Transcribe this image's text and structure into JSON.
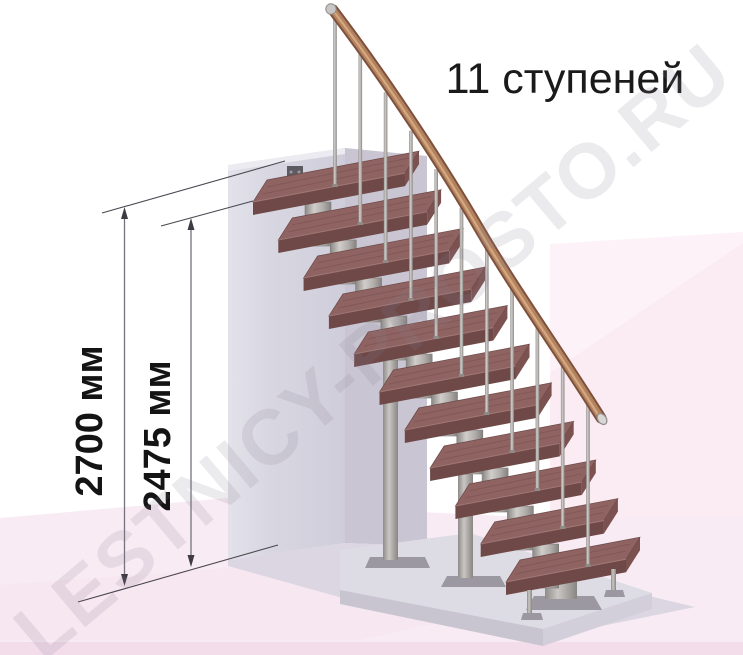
{
  "title": "11 ступеней",
  "watermark": "LESTNICY-PROSTO.RU",
  "staircase": {
    "step_count": 11,
    "description_label": "11 ступеней"
  },
  "dimensions": {
    "total_height": {
      "label": "2700 мм",
      "value": 2700,
      "unit": "мм"
    },
    "to_top_step": {
      "label": "2475 мм",
      "value": 2475,
      "unit": "мм"
    }
  },
  "colors": {
    "tread_top": "#8f6361",
    "tread_front": "#6e4948",
    "tread_end": "#7c5251",
    "tread_edge": "#6d4a49",
    "tread_streak": "#714c4b",
    "tread_highlight": "#ab817d",
    "rail_dark": "#7e513c",
    "rail_mid": "#b3835f",
    "rail_light": "#d8ac85",
    "metal_dark": "#898683",
    "metal_light": "#cfccc9",
    "baluster": "#a3a09d",
    "wall_front": "#dadae3",
    "wall_side": "#c9c5d2",
    "floor_pink": "#f8ebf4",
    "far_wall_pink": "#fdf2f8",
    "shadow": "#dcd6e2",
    "platform_top": "#dddbe3",
    "dim_line": "#4c4751",
    "text": "#1a1a1a"
  }
}
